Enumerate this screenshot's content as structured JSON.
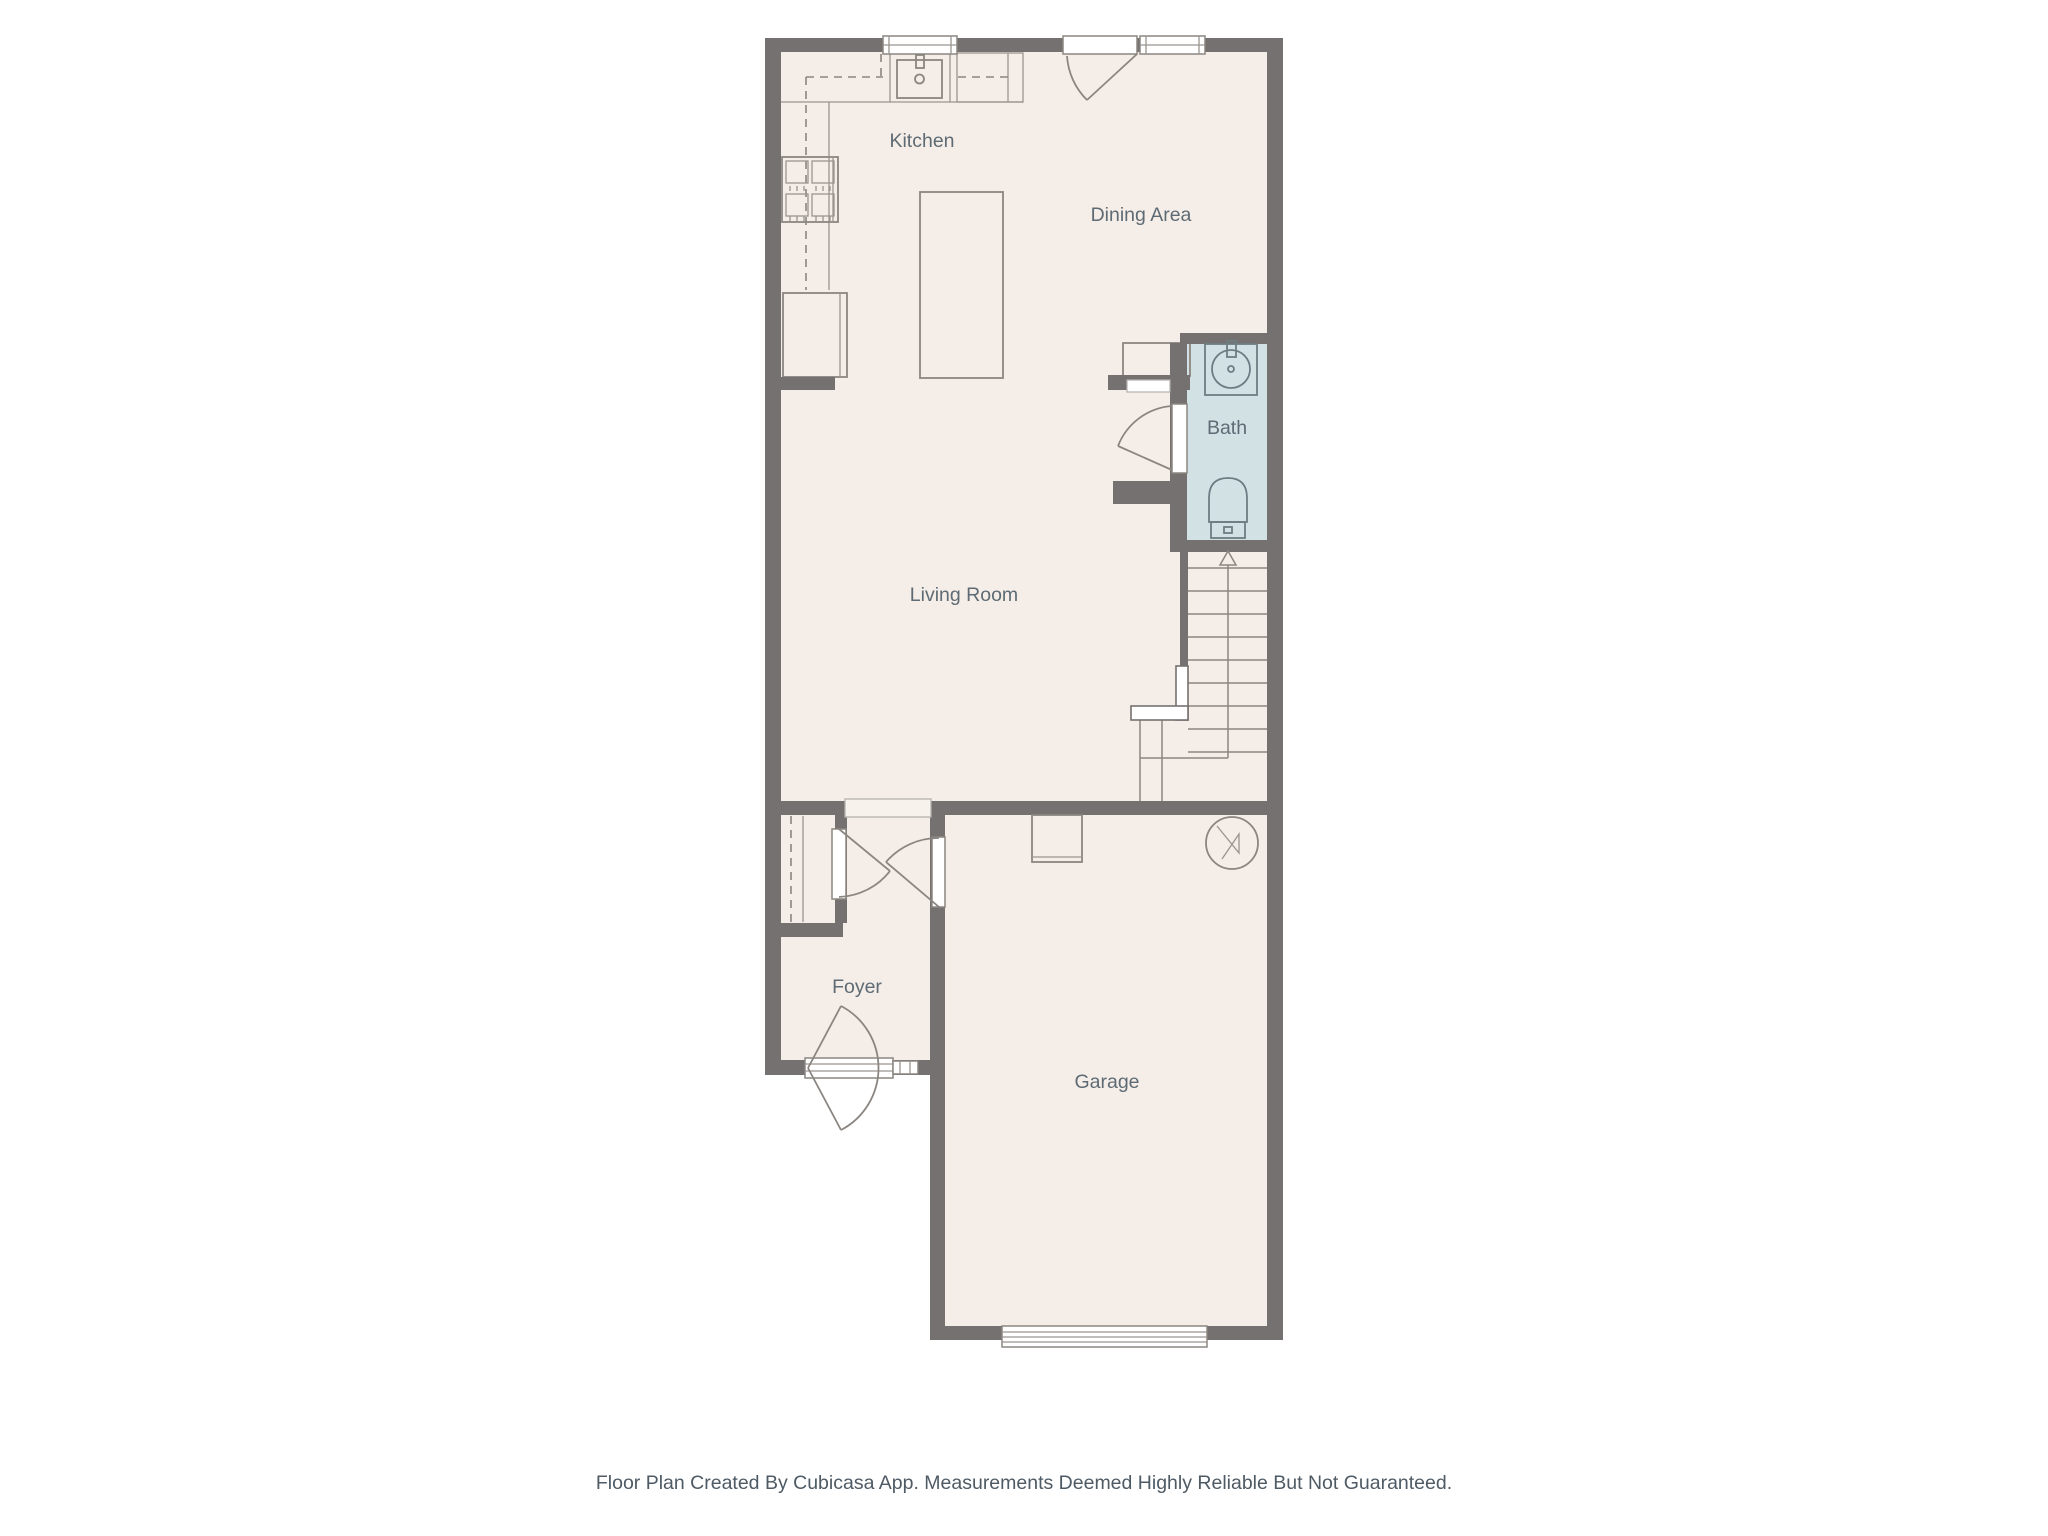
{
  "colors": {
    "background": "#ffffff",
    "wall": "#757170",
    "floor": "#f5eee8",
    "bath_floor": "#d2e2e4",
    "fixture_outline": "#8b8681",
    "bath_fixture_outline": "#6e7d83",
    "room_label_text": "#5e6b74",
    "footer_text": "#4e5a64"
  },
  "rooms": {
    "kitchen": "Kitchen",
    "dining": "Dining Area",
    "bath": "Bath",
    "living": "Living Room",
    "foyer": "Foyer",
    "garage": "Garage"
  },
  "stairs": {
    "direction": "up"
  },
  "fixtures": [
    "kitchen-window",
    "kitchen-sink",
    "dishwasher-cabinet",
    "cooktop",
    "refrigerator",
    "kitchen-island",
    "dining-exterior-door",
    "dining-window",
    "dining-bench",
    "bathroom-vanity-sink",
    "toilet",
    "bath-door",
    "staircase-up",
    "foyer-closet",
    "front-door",
    "front-door-sidelite",
    "garage-interior-door",
    "furnace",
    "water-heater",
    "garage-vehicle-door"
  ],
  "footer": {
    "disclaimer": "Floor Plan Created By Cubicasa App. Measurements Deemed Highly Reliable But Not Guaranteed."
  }
}
